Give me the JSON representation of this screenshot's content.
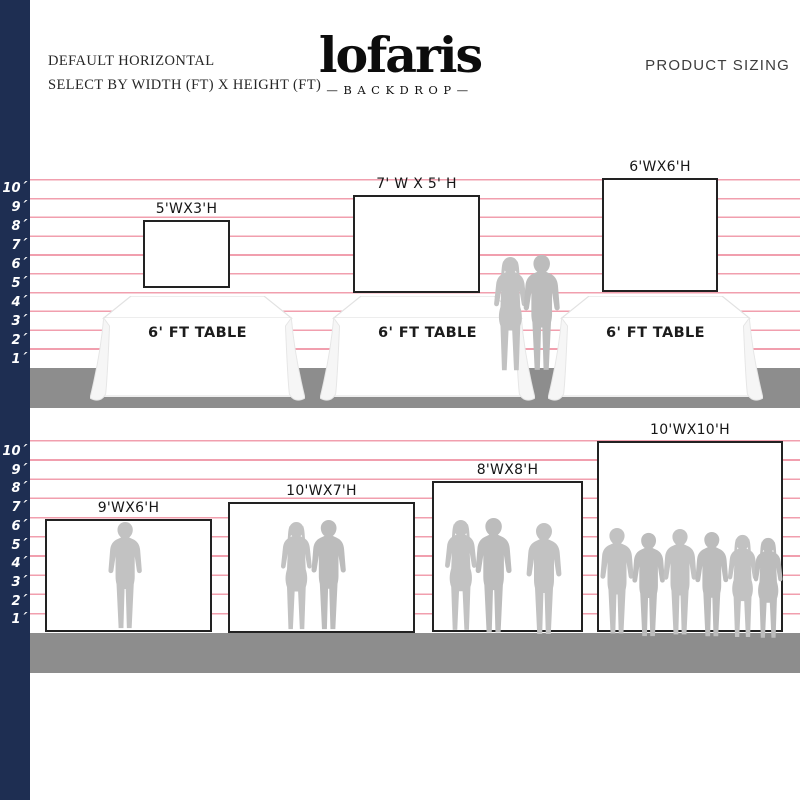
{
  "header": {
    "line1": "DEFAULT HORIZONTAL",
    "line2": "SELECT BY WIDTH (FT) X HEIGHT (FT)",
    "logo_text": "lofaris",
    "logo_tagline": "—BACKDROP—",
    "right_title": "PRODUCT SIZING"
  },
  "ruler": {
    "labels": [
      "10´",
      "9´",
      "8´",
      "7´",
      "6´",
      "5´",
      "4´",
      "3´",
      "2´",
      "1´"
    ]
  },
  "rows": [
    {
      "name": "horizontal-backdrops-with-tables",
      "table_label": "6' FT TABLE",
      "backdrops": [
        {
          "label": "5'WX3'H",
          "width_ft": 5,
          "height_ft": 3
        },
        {
          "label": "7' W X 5' H",
          "width_ft": 7,
          "height_ft": 5
        },
        {
          "label": "6'WX6'H",
          "width_ft": 6,
          "height_ft": 6
        }
      ]
    },
    {
      "name": "large-backdrops-with-people",
      "backdrops": [
        {
          "label": "9'WX6'H",
          "width_ft": 9,
          "height_ft": 6
        },
        {
          "label": "10'WX7'H",
          "width_ft": 10,
          "height_ft": 7
        },
        {
          "label": "8'WX8'H",
          "width_ft": 8,
          "height_ft": 8
        },
        {
          "label": "10'WX10'H",
          "width_ft": 10,
          "height_ft": 10
        }
      ]
    }
  ],
  "colors": {
    "navy_bar": "#1e2e52",
    "grid_pink": "#f19fae",
    "floor_gray": "#8d8d8d",
    "silhouette_gray": "#c2c2c2"
  }
}
